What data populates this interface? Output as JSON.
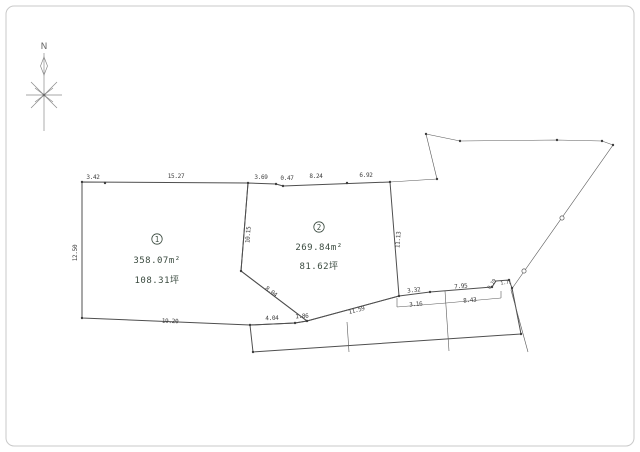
{
  "compass": {
    "north": "N"
  },
  "parcel1": {
    "number": "1",
    "area_sqm": "358.07m²",
    "area_tsubo": "108.31坪"
  },
  "parcel2": {
    "number": "2",
    "area_sqm": "269.84m²",
    "area_tsubo": "81.62坪"
  },
  "dims": {
    "top1": "3.42",
    "top2": "15.27",
    "top3": "3.69",
    "top4": "0.47",
    "top5": "8.24",
    "top6": "6.92",
    "left": "12.50",
    "divider": "10.15",
    "diagonal": "8.04",
    "right": "11.13",
    "bottom1": "19.20",
    "bottom2": "4.04",
    "bottom3": "1.86",
    "bottom4": "11.59",
    "road_top1": "3.32",
    "road_top2": "7.95",
    "road_mid1": "3.16",
    "road_mid2": "8.43",
    "road_corner1": "0.19",
    "road_corner2": "1.71"
  },
  "colors": {
    "parcel_fill": "#dcecd7",
    "road_fill": "#b5b8ba",
    "line": "#4f4f4f",
    "frame": "#c9c9c9"
  }
}
